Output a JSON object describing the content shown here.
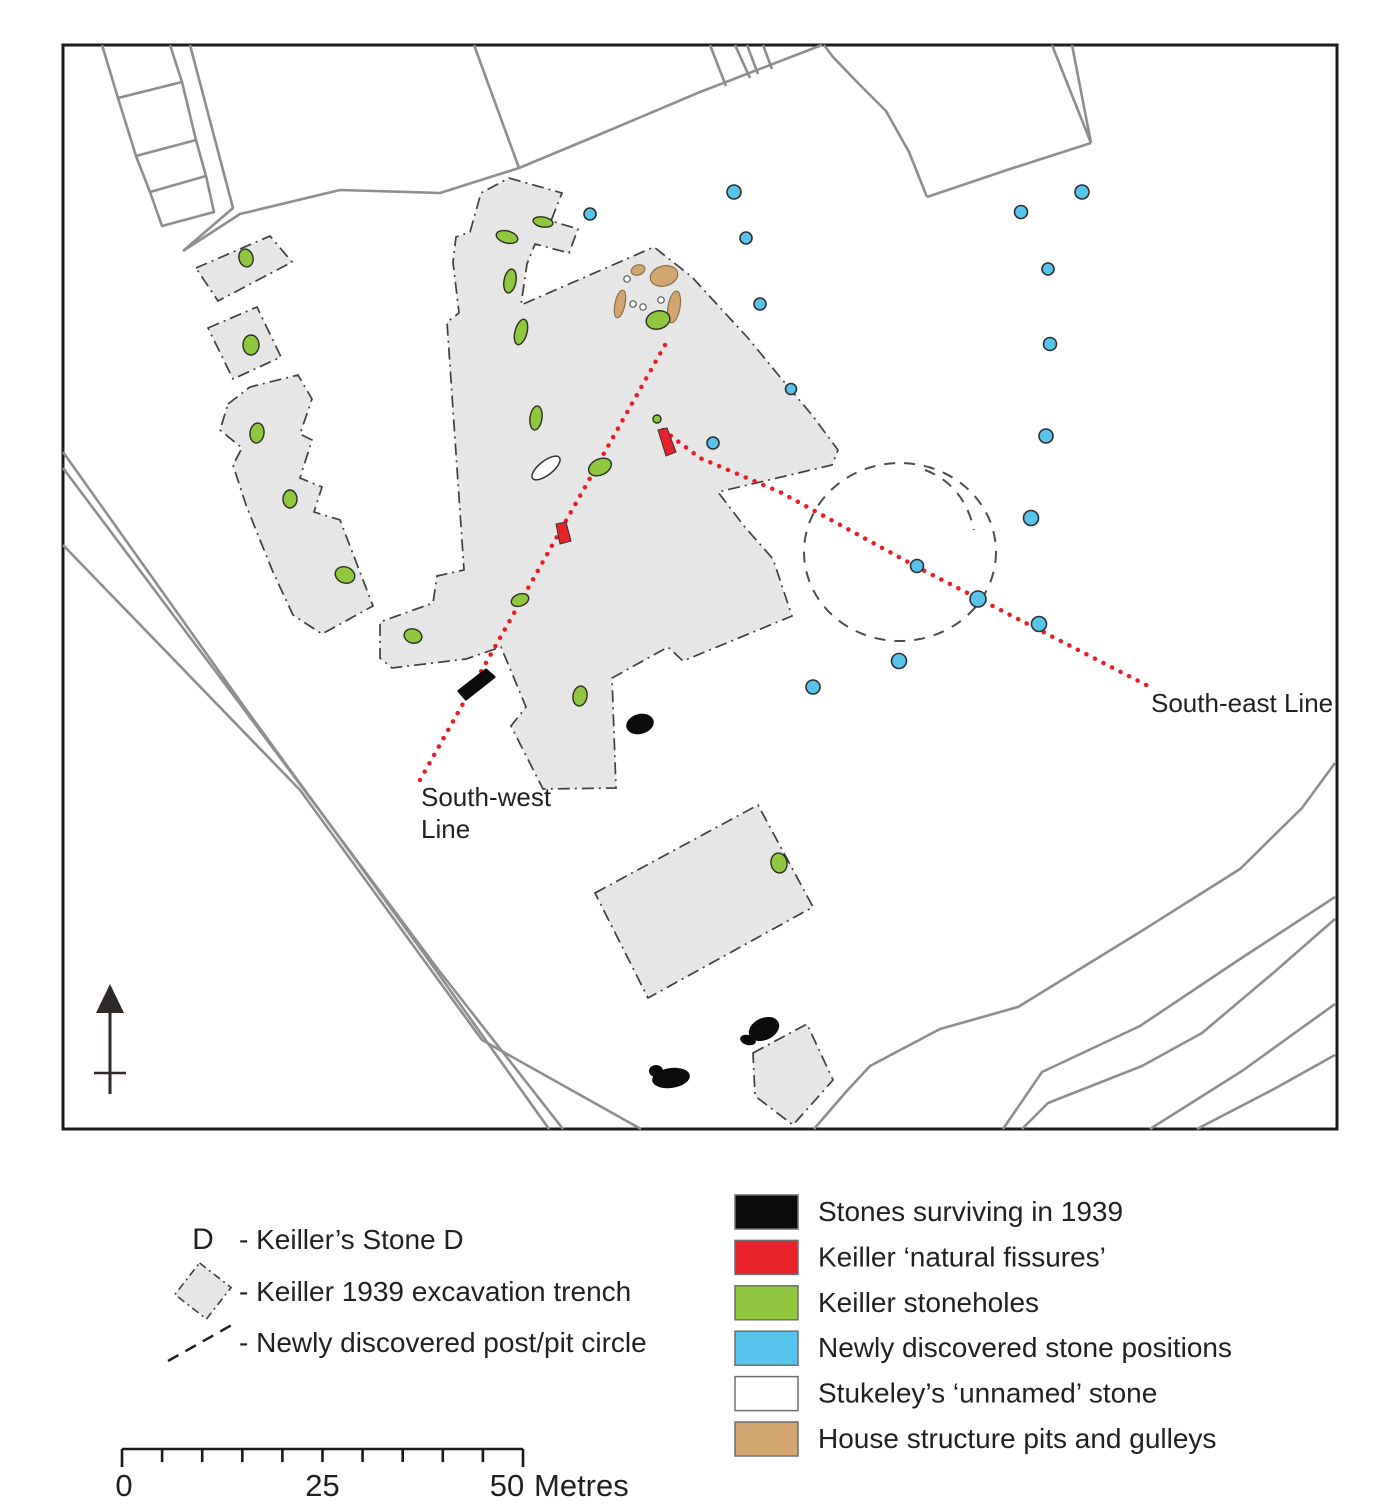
{
  "colors": {
    "frame": "#1c1c1c",
    "field_line": "#8e8e8e",
    "trench_fill": "#e6e6e6",
    "trench_stroke": "#3f3f3f",
    "black_stone": "#0b0b0b",
    "fissure_red": "#e8222a",
    "stonehole_green": "#8fc73f",
    "stone_blue": "#57c4ee",
    "house_tan": "#d3a571",
    "white_stone": "#ffffff",
    "circle_stroke": "#4d4d4d",
    "alignment_red": "#ec1c24",
    "text": "#231f20",
    "north_arrow": "#2e2926"
  },
  "map": {
    "labels": {
      "south_west_1": "South-west",
      "south_west_2": "Line",
      "south_east": "South-east Line"
    },
    "features": {
      "frame": {
        "x": 63,
        "y": 45,
        "w": 1274,
        "h": 1084
      },
      "boundary_lines": [
        [
          [
            102,
            45
          ],
          [
            118,
            98
          ],
          [
            136,
            156
          ],
          [
            150,
            192
          ],
          [
            162,
            226
          ],
          [
            214,
            212
          ],
          [
            206,
            176
          ],
          [
            196,
            140
          ],
          [
            182,
            82
          ],
          [
            170,
            45
          ]
        ],
        [
          [
            118,
            98
          ],
          [
            182,
            82
          ]
        ],
        [
          [
            136,
            156
          ],
          [
            196,
            140
          ]
        ],
        [
          [
            150,
            192
          ],
          [
            206,
            176
          ]
        ],
        [
          [
            190,
            45
          ],
          [
            233,
            208
          ],
          [
            183,
            251
          ]
        ],
        [
          [
            183,
            251
          ],
          [
            240,
            214
          ],
          [
            340,
            190
          ],
          [
            440,
            193
          ],
          [
            519,
            168
          ],
          [
            603,
            133
          ],
          [
            700,
            92
          ],
          [
            822,
            45
          ]
        ],
        [
          [
            474,
            45
          ],
          [
            519,
            168
          ]
        ],
        [
          [
            710,
            45
          ],
          [
            726,
            86
          ]
        ],
        [
          [
            735,
            45
          ],
          [
            750,
            78
          ]
        ],
        [
          [
            747,
            45
          ],
          [
            758,
            74
          ]
        ],
        [
          [
            763,
            45
          ],
          [
            772,
            69
          ]
        ],
        [
          [
            824,
            45
          ],
          [
            833,
            57
          ],
          [
            858,
            83
          ],
          [
            886,
            111
          ],
          [
            909,
            152
          ],
          [
            927,
            197
          ]
        ],
        [
          [
            927,
            197
          ],
          [
            1010,
            169
          ],
          [
            1091,
            143
          ]
        ],
        [
          [
            1091,
            143
          ],
          [
            1052,
            45
          ]
        ],
        [
          [
            1091,
            143
          ],
          [
            1072,
            45
          ]
        ],
        [
          [
            63,
            452
          ],
          [
            245,
            708
          ],
          [
            425,
            955
          ],
          [
            549,
            1129
          ]
        ],
        [
          [
            63,
            468
          ],
          [
            255,
            724
          ],
          [
            437,
            968
          ],
          [
            563,
            1129
          ]
        ],
        [
          [
            63,
            545
          ],
          [
            300,
            790
          ],
          [
            482,
            1040
          ],
          [
            641,
            1129
          ]
        ],
        [
          [
            814,
            1129
          ],
          [
            845,
            1093
          ],
          [
            870,
            1066
          ],
          [
            940,
            1029
          ],
          [
            1018,
            1007
          ],
          [
            1140,
            932
          ],
          [
            1240,
            869
          ],
          [
            1302,
            808
          ],
          [
            1335,
            763
          ]
        ],
        [
          [
            1003,
            1129
          ],
          [
            1042,
            1072
          ],
          [
            1140,
            1026
          ],
          [
            1240,
            959
          ],
          [
            1335,
            897
          ]
        ],
        [
          [
            1022,
            1129
          ],
          [
            1048,
            1103
          ],
          [
            1142,
            1066
          ],
          [
            1202,
            1033
          ],
          [
            1272,
            974
          ],
          [
            1335,
            919
          ]
        ],
        [
          [
            1150,
            1129
          ],
          [
            1242,
            1071
          ],
          [
            1335,
            1004
          ]
        ],
        [
          [
            1197,
            1129
          ],
          [
            1274,
            1089
          ],
          [
            1335,
            1055
          ]
        ]
      ],
      "trenches": [
        [
          [
            196,
            268
          ],
          [
            270,
            236
          ],
          [
            292,
            262
          ],
          [
            218,
            301
          ]
        ],
        [
          [
            208,
            328
          ],
          [
            257,
            307
          ],
          [
            281,
            357
          ],
          [
            233,
            379
          ]
        ],
        [
          [
            228,
            404
          ],
          [
            250,
            387
          ],
          [
            298,
            375
          ],
          [
            312,
            399
          ],
          [
            300,
            434
          ],
          [
            312,
            440
          ],
          [
            300,
            478
          ],
          [
            322,
            487
          ],
          [
            314,
            512
          ],
          [
            340,
            520
          ],
          [
            373,
            606
          ],
          [
            322,
            634
          ],
          [
            293,
            615
          ],
          [
            273,
            572
          ],
          [
            260,
            540
          ],
          [
            246,
            505
          ],
          [
            233,
            465
          ],
          [
            242,
            448
          ],
          [
            220,
            430
          ]
        ],
        [
          [
            509,
            178
          ],
          [
            562,
            193
          ],
          [
            551,
            221
          ],
          [
            578,
            229
          ],
          [
            569,
            253
          ],
          [
            535,
            244
          ],
          [
            527,
            264
          ],
          [
            521,
            305
          ],
          [
            654,
            247
          ],
          [
            692,
            277
          ],
          [
            713,
            300
          ],
          [
            748,
            338
          ],
          [
            780,
            377
          ],
          [
            812,
            415
          ],
          [
            838,
            450
          ],
          [
            832,
            465
          ],
          [
            718,
            492
          ],
          [
            744,
            526
          ],
          [
            773,
            559
          ],
          [
            792,
            616
          ],
          [
            683,
            661
          ],
          [
            668,
            647
          ],
          [
            612,
            678
          ],
          [
            616,
            788
          ],
          [
            543,
            789
          ],
          [
            511,
            726
          ],
          [
            526,
            707
          ],
          [
            501,
            647
          ],
          [
            466,
            659
          ],
          [
            392,
            668
          ],
          [
            380,
            658
          ],
          [
            380,
            622
          ],
          [
            433,
            603
          ],
          [
            437,
            576
          ],
          [
            464,
            570
          ],
          [
            447,
            322
          ],
          [
            459,
            313
          ],
          [
            453,
            262
          ],
          [
            456,
            237
          ],
          [
            470,
            232
          ],
          [
            481,
            193
          ]
        ],
        [
          [
            595,
            893
          ],
          [
            758,
            805
          ],
          [
            813,
            907
          ],
          [
            648,
            998
          ]
        ],
        [
          [
            753,
            1053
          ],
          [
            807,
            1024
          ],
          [
            833,
            1080
          ],
          [
            826,
            1088
          ],
          [
            793,
            1125
          ],
          [
            755,
            1096
          ]
        ]
      ],
      "post_pit_circle": {
        "cx": 900,
        "cy": 552,
        "rx": 96,
        "ry": 89,
        "dent": "M 925 470 C 952 480 968 502 974 530"
      },
      "alignment_lines": {
        "south_west": [
          [
            665,
            345
          ],
          [
            420,
            780
          ]
        ],
        "south_east": [
          [
            663,
            430
          ],
          [
            700,
            458
          ],
          [
            780,
            492
          ],
          [
            917,
            567
          ],
          [
            1152,
            688
          ]
        ]
      },
      "house_pits": [
        [
          638,
          270,
          7,
          5,
          -20
        ],
        [
          664,
          276,
          14,
          10,
          -15
        ],
        [
          620,
          304,
          5,
          14,
          12
        ],
        [
          674,
          307,
          6,
          16,
          10
        ]
      ],
      "white_pits": [
        [
          627,
          279
        ],
        [
          633,
          304
        ],
        [
          643,
          307
        ],
        [
          661,
          300
        ]
      ],
      "white_stone": [
        546,
        468,
        17,
        7,
        -38
      ],
      "stoneholes": [
        [
          246,
          258,
          7,
          9,
          -15
        ],
        [
          251,
          345,
          8,
          10,
          0
        ],
        [
          257,
          433,
          7,
          10,
          8
        ],
        [
          290,
          499,
          7,
          9,
          0
        ],
        [
          345,
          575,
          10,
          8,
          20
        ],
        [
          413,
          636,
          9,
          7,
          15
        ],
        [
          507,
          237,
          11,
          6,
          15
        ],
        [
          543,
          222,
          10,
          5,
          10
        ],
        [
          510,
          281,
          6,
          12,
          10
        ],
        [
          521,
          332,
          6,
          13,
          15
        ],
        [
          536,
          418,
          6,
          12,
          8
        ],
        [
          600,
          467,
          12,
          8,
          -25
        ],
        [
          658,
          320,
          12,
          9,
          -15
        ],
        [
          520,
          600,
          9,
          6,
          -20
        ],
        [
          580,
          696,
          7,
          10,
          10
        ],
        [
          779,
          863,
          8,
          10,
          -10
        ],
        [
          657,
          419,
          4,
          4,
          0
        ]
      ],
      "fissures": [
        [
          [
            556,
            524
          ],
          [
            566,
            522
          ],
          [
            571,
            541
          ],
          [
            560,
            544
          ]
        ],
        [
          [
            658,
            430
          ],
          [
            667,
            428
          ],
          [
            676,
            452
          ],
          [
            666,
            456
          ]
        ]
      ],
      "black_stones_poly": [
        [
          [
            459,
            691
          ],
          [
            486,
            670
          ],
          [
            494,
            677
          ],
          [
            466,
            699
          ]
        ]
      ],
      "black_stones_ellipse": [
        [
          640,
          724,
          14,
          10,
          -15
        ],
        [
          764,
          1029,
          16,
          11,
          -25
        ],
        [
          748,
          1040,
          8,
          5,
          15
        ],
        [
          671,
          1078,
          19,
          10,
          -8
        ],
        [
          656,
          1071,
          7,
          6,
          0
        ]
      ],
      "blue_stones": [
        [
          590,
          214,
          6
        ],
        [
          734,
          192,
          7
        ],
        [
          746,
          238,
          6
        ],
        [
          760,
          304,
          6
        ],
        [
          791,
          389,
          5.5
        ],
        [
          713,
          443,
          6
        ],
        [
          1082,
          192,
          7
        ],
        [
          1021,
          212,
          6.5
        ],
        [
          1048,
          269,
          6
        ],
        [
          1050,
          344,
          6.5
        ],
        [
          1046,
          436,
          7
        ],
        [
          1031,
          518,
          7.5
        ],
        [
          917,
          566,
          6.5
        ],
        [
          978,
          599,
          8
        ],
        [
          1039,
          624,
          7.5
        ],
        [
          899,
          661,
          7.5
        ],
        [
          813,
          687,
          7
        ]
      ]
    }
  },
  "legend_left": {
    "items": [
      {
        "symbol": "letter",
        "letter": "D",
        "label": "- Keiller’s Stone D"
      },
      {
        "symbol": "trench",
        "label": "- Keiller 1939 excavation trench"
      },
      {
        "symbol": "dashed-line",
        "label": "- Newly discovered post/pit circle"
      }
    ]
  },
  "legend_right": {
    "items": [
      {
        "color": "#0b0b0b",
        "label": "Stones surviving in 1939"
      },
      {
        "color": "#e8222a",
        "label": "Keiller ‘natural fissures’"
      },
      {
        "color": "#8fc73f",
        "label": "Keiller stoneholes"
      },
      {
        "color": "#57c4ee",
        "label": "Newly discovered stone positions"
      },
      {
        "color": "#ffffff",
        "label": "Stukeley’s ‘unnamed’ stone"
      },
      {
        "color": "#d3a571",
        "label": "House structure pits and gulleys"
      }
    ]
  },
  "scale_bar": {
    "divisions": 10,
    "start_label": "0",
    "mid_label": "25",
    "end_label": "50",
    "unit": "Metres"
  }
}
